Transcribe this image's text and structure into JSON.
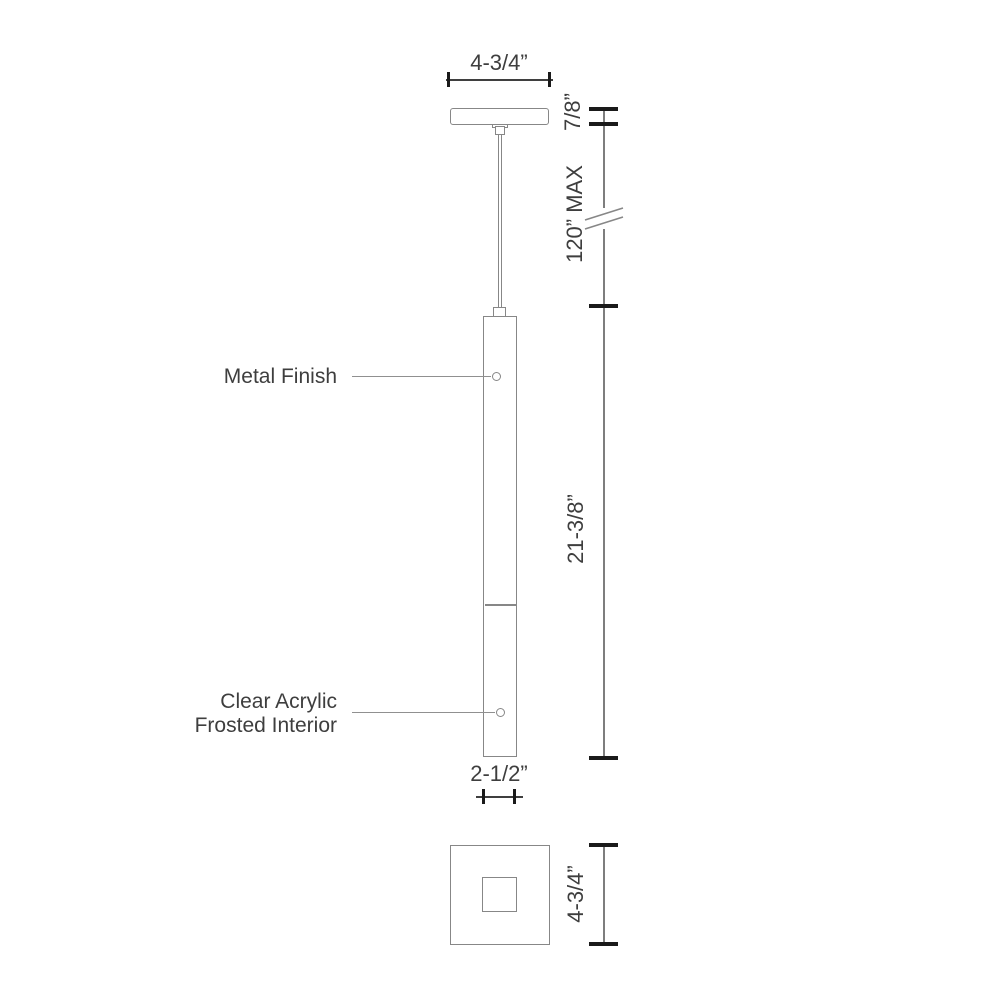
{
  "drawing": {
    "type": "pendant-light-dimension-drawing",
    "annotations": {
      "metal_finish": "Metal Finish",
      "clear_acrylic_line1": "Clear Acrylic",
      "clear_acrylic_line2": "Frosted Interior"
    },
    "dimensions": {
      "canopy_width": "4-3/4”",
      "canopy_height": "7/8”",
      "suspension_max": "120” MAX",
      "body_length": "21-3/8”",
      "body_diameter": "2-1/2”",
      "canopy_plan_size": "4-3/4”"
    },
    "colors": {
      "background": "#ffffff",
      "outline": "#878787",
      "leader": "#909090",
      "dimension_h": "#3f3f3f",
      "dimension_v": "#7e7e7e",
      "tick": "#1a1a1a",
      "text": "#3e3e3e"
    }
  }
}
